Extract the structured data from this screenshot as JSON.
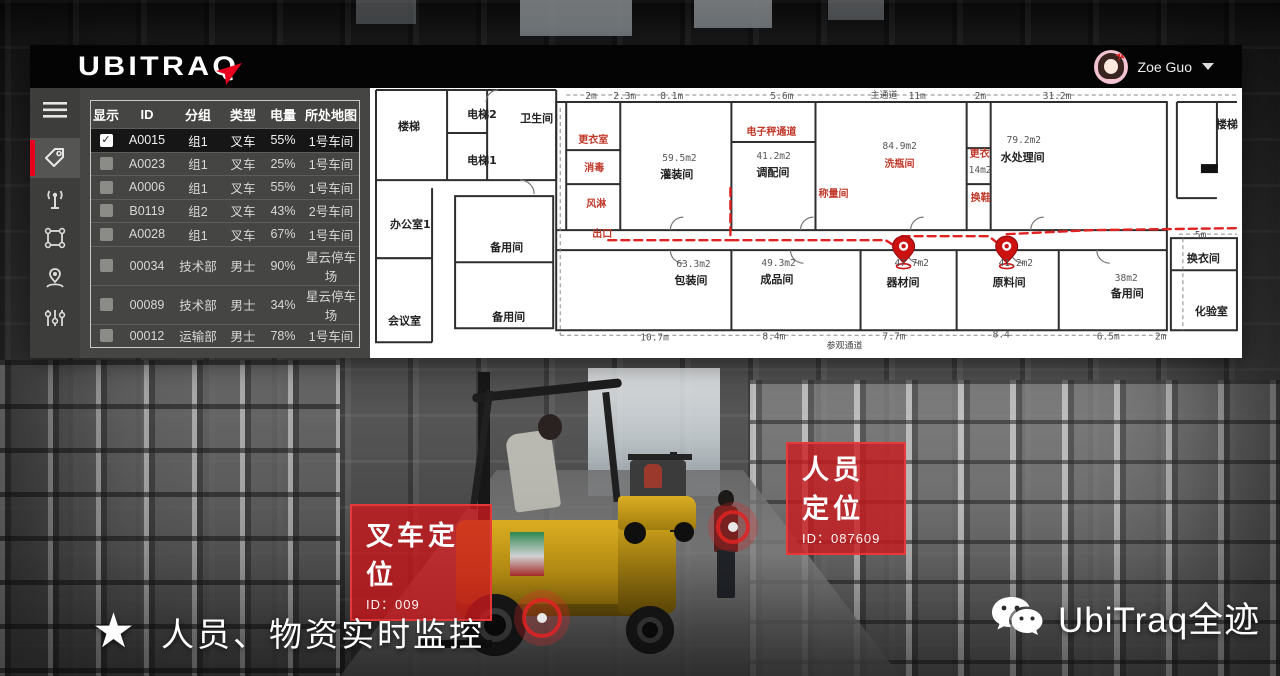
{
  "header": {
    "logo": "UBITRAQ",
    "user_name": "Zoe Guo"
  },
  "sidebar": {
    "items": [
      {
        "name": "menu"
      },
      {
        "name": "tag-tracking",
        "active": true
      },
      {
        "name": "signal"
      },
      {
        "name": "zone"
      },
      {
        "name": "person-location"
      },
      {
        "name": "statistics"
      }
    ]
  },
  "icons": {
    "checked_glyph": "✓",
    "star_glyph": "★"
  },
  "table": {
    "columns": [
      "显示",
      "ID",
      "分组",
      "类型",
      "电量",
      "所处地图"
    ],
    "rows": [
      {
        "checked": true,
        "id": "A0015",
        "group": "组1",
        "type": "叉车",
        "battery": "55%",
        "map": "1号车间",
        "selected": true
      },
      {
        "checked": false,
        "id": "A0023",
        "group": "组1",
        "type": "叉车",
        "battery": "25%",
        "map": "1号车间"
      },
      {
        "checked": false,
        "id": "A0006",
        "group": "组1",
        "type": "叉车",
        "battery": "55%",
        "map": "1号车间"
      },
      {
        "checked": false,
        "id": "B0119",
        "group": "组2",
        "type": "叉车",
        "battery": "43%",
        "map": "2号车间"
      },
      {
        "checked": false,
        "id": "A0028",
        "group": "组1",
        "type": "叉车",
        "battery": "67%",
        "map": "1号车间"
      },
      {
        "checked": false,
        "id": "00034",
        "group": "技术部",
        "type": "男士",
        "battery": "90%",
        "map": "星云停车场"
      },
      {
        "checked": false,
        "id": "00089",
        "group": "技术部",
        "type": "男士",
        "battery": "34%",
        "map": "星云停车场"
      },
      {
        "checked": false,
        "id": "00012",
        "group": "运输部",
        "type": "男士",
        "battery": "78%",
        "map": "1号车间"
      }
    ]
  },
  "floorplan": {
    "labels": [
      {
        "t": "2m",
        "x": 215,
        "y": 11,
        "c": "d"
      },
      {
        "t": "2.3m",
        "x": 243,
        "y": 11,
        "c": "d"
      },
      {
        "t": "8.1m",
        "x": 290,
        "y": 11,
        "c": "d"
      },
      {
        "t": "5.6m",
        "x": 400,
        "y": 11,
        "c": "d"
      },
      {
        "t": "主通道",
        "x": 500,
        "y": 10,
        "c": "m"
      },
      {
        "t": "11m",
        "x": 538,
        "y": 11,
        "c": "d"
      },
      {
        "t": "2m",
        "x": 604,
        "y": 11,
        "c": "d"
      },
      {
        "t": "31.2m",
        "x": 672,
        "y": 11,
        "c": "d"
      },
      {
        "t": "5m",
        "x": 824,
        "y": 150,
        "c": "d"
      },
      {
        "t": "楼梯",
        "x": 28,
        "y": 42,
        "c": "k"
      },
      {
        "t": "电梯2",
        "x": 97,
        "y": 30,
        "c": "k"
      },
      {
        "t": "电梯1",
        "x": 97,
        "y": 76,
        "c": "k"
      },
      {
        "t": "卫生间",
        "x": 150,
        "y": 34,
        "c": "k"
      },
      {
        "t": "办公室1",
        "x": 20,
        "y": 140,
        "c": "k"
      },
      {
        "t": "会议室",
        "x": 18,
        "y": 236,
        "c": "k"
      },
      {
        "t": "备用间",
        "x": 120,
        "y": 163,
        "c": "k"
      },
      {
        "t": "备用间",
        "x": 122,
        "y": 232,
        "c": "k"
      },
      {
        "t": "更衣室",
        "x": 208,
        "y": 55,
        "c": "r"
      },
      {
        "t": "消毒",
        "x": 214,
        "y": 83,
        "c": "r"
      },
      {
        "t": "风淋",
        "x": 216,
        "y": 119,
        "c": "r"
      },
      {
        "t": "59.5m2",
        "x": 292,
        "y": 73,
        "c": "d"
      },
      {
        "t": "灌装间",
        "x": 290,
        "y": 90,
        "c": "k"
      },
      {
        "t": "电子秤通道",
        "x": 376,
        "y": 47,
        "c": "r"
      },
      {
        "t": "41.2m2",
        "x": 386,
        "y": 71,
        "c": "d"
      },
      {
        "t": "调配间",
        "x": 386,
        "y": 88,
        "c": "k"
      },
      {
        "t": "称量间",
        "x": 448,
        "y": 109,
        "c": "r"
      },
      {
        "t": "84.9m2",
        "x": 512,
        "y": 61,
        "c": "d"
      },
      {
        "t": "洗瓶间",
        "x": 514,
        "y": 79,
        "c": "r"
      },
      {
        "t": "更衣",
        "x": 599,
        "y": 69,
        "c": "r"
      },
      {
        "t": "14m2",
        "x": 598,
        "y": 85,
        "c": "d"
      },
      {
        "t": "换鞋",
        "x": 600,
        "y": 113,
        "c": "r"
      },
      {
        "t": "79.2m2",
        "x": 636,
        "y": 55,
        "c": "d"
      },
      {
        "t": "水处理间",
        "x": 630,
        "y": 73,
        "c": "k"
      },
      {
        "t": "楼梯",
        "x": 845,
        "y": 40,
        "c": "k"
      },
      {
        "t": "出口",
        "x": 222,
        "y": 149,
        "c": "r"
      },
      {
        "t": "63.3m2",
        "x": 306,
        "y": 179,
        "c": "d"
      },
      {
        "t": "包装间",
        "x": 304,
        "y": 196,
        "c": "k"
      },
      {
        "t": "49.3m2",
        "x": 391,
        "y": 178,
        "c": "d"
      },
      {
        "t": "成品间",
        "x": 390,
        "y": 195,
        "c": "k"
      },
      {
        "t": "47.7m2",
        "x": 524,
        "y": 178,
        "c": "d"
      },
      {
        "t": "器材间",
        "x": 516,
        "y": 198,
        "c": "k"
      },
      {
        "t": "41.2m2",
        "x": 628,
        "y": 178,
        "c": "d"
      },
      {
        "t": "原料间",
        "x": 622,
        "y": 198,
        "c": "k"
      },
      {
        "t": "38m2",
        "x": 744,
        "y": 193,
        "c": "d"
      },
      {
        "t": "备用间",
        "x": 740,
        "y": 209,
        "c": "k"
      },
      {
        "t": "换衣间",
        "x": 816,
        "y": 174,
        "c": "k"
      },
      {
        "t": "化验室",
        "x": 824,
        "y": 227,
        "c": "k"
      },
      {
        "t": "10.7m",
        "x": 270,
        "y": 252,
        "c": "d"
      },
      {
        "t": "8.4m",
        "x": 392,
        "y": 251,
        "c": "d"
      },
      {
        "t": "参观通道",
        "x": 456,
        "y": 260,
        "c": "m"
      },
      {
        "t": "7.7m",
        "x": 512,
        "y": 251,
        "c": "d"
      },
      {
        "t": "8.4",
        "x": 622,
        "y": 249,
        "c": "d"
      },
      {
        "t": "6.5m",
        "x": 726,
        "y": 251,
        "c": "d"
      },
      {
        "t": "2m",
        "x": 784,
        "y": 251,
        "c": "d"
      }
    ]
  },
  "overlays": {
    "person_tag": {
      "title": "人员定位",
      "id_label": "ID：087609"
    },
    "forklift_tag": {
      "title": "叉车定位",
      "id_label": "ID：009"
    }
  },
  "footer": {
    "slogan": "人员、物资实时监控",
    "brand": "UbiTraq全迹"
  },
  "colors": {
    "accent_red": "#e8001e",
    "marker_red": "#cc1111",
    "map_bg": "#ffffff",
    "header_bg": "#040404"
  }
}
